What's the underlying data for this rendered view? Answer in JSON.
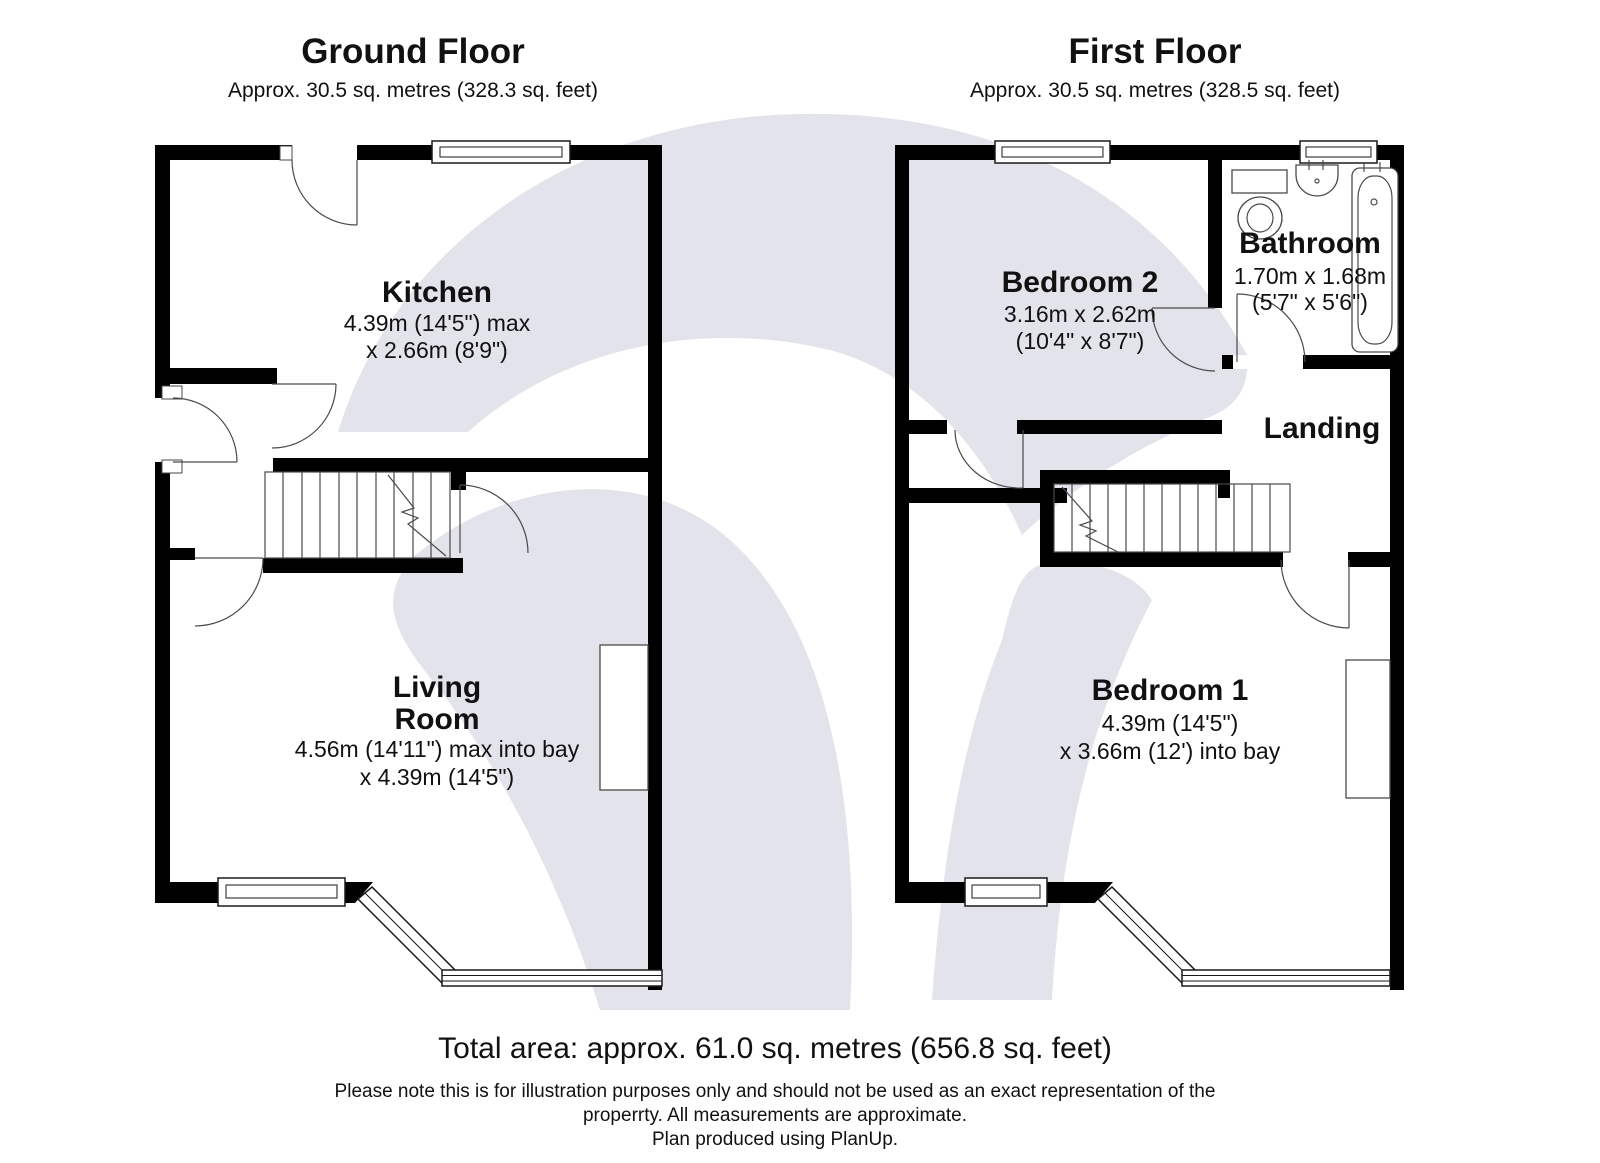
{
  "colors": {
    "wall": "#000000",
    "watermark": "#e3e3ec",
    "text": "#111111"
  },
  "ground_floor": {
    "title": "Ground Floor",
    "subtitle": "Approx. 30.5 sq. metres (328.3 sq. feet)",
    "rooms": {
      "kitchen": {
        "name": "Kitchen",
        "dim1": "4.39m (14'5\") max",
        "dim2": "x 2.66m (8'9\")"
      },
      "living_room": {
        "name_line1": "Living",
        "name_line2": "Room",
        "dim1": "4.56m (14'11\") max into bay",
        "dim2": "x 4.39m (14'5\")"
      }
    }
  },
  "first_floor": {
    "title": "First Floor",
    "subtitle": "Approx. 30.5 sq. metres (328.5 sq. feet)",
    "rooms": {
      "bedroom2": {
        "name": "Bedroom 2",
        "dim1": "3.16m x 2.62m",
        "dim2": "(10'4\" x 8'7\")"
      },
      "bathroom": {
        "name": "Bathroom",
        "dim1": "1.70m x 1.68m",
        "dim2": "(5'7\" x 5'6\")"
      },
      "landing": {
        "name": "Landing"
      },
      "bedroom1": {
        "name": "Bedroom 1",
        "dim1": "4.39m (14'5\")",
        "dim2": "x 3.66m (12') into bay"
      }
    }
  },
  "footer": {
    "total_area": "Total area: approx. 61.0 sq. metres (656.8 sq. feet)",
    "disclaimer_line1": "Please note this is for illustration purposes only and should not be used as an exact representation of the",
    "disclaimer_line2": "properrty. All measurements are approximate.",
    "disclaimer_line3": "Plan produced using PlanUp."
  }
}
